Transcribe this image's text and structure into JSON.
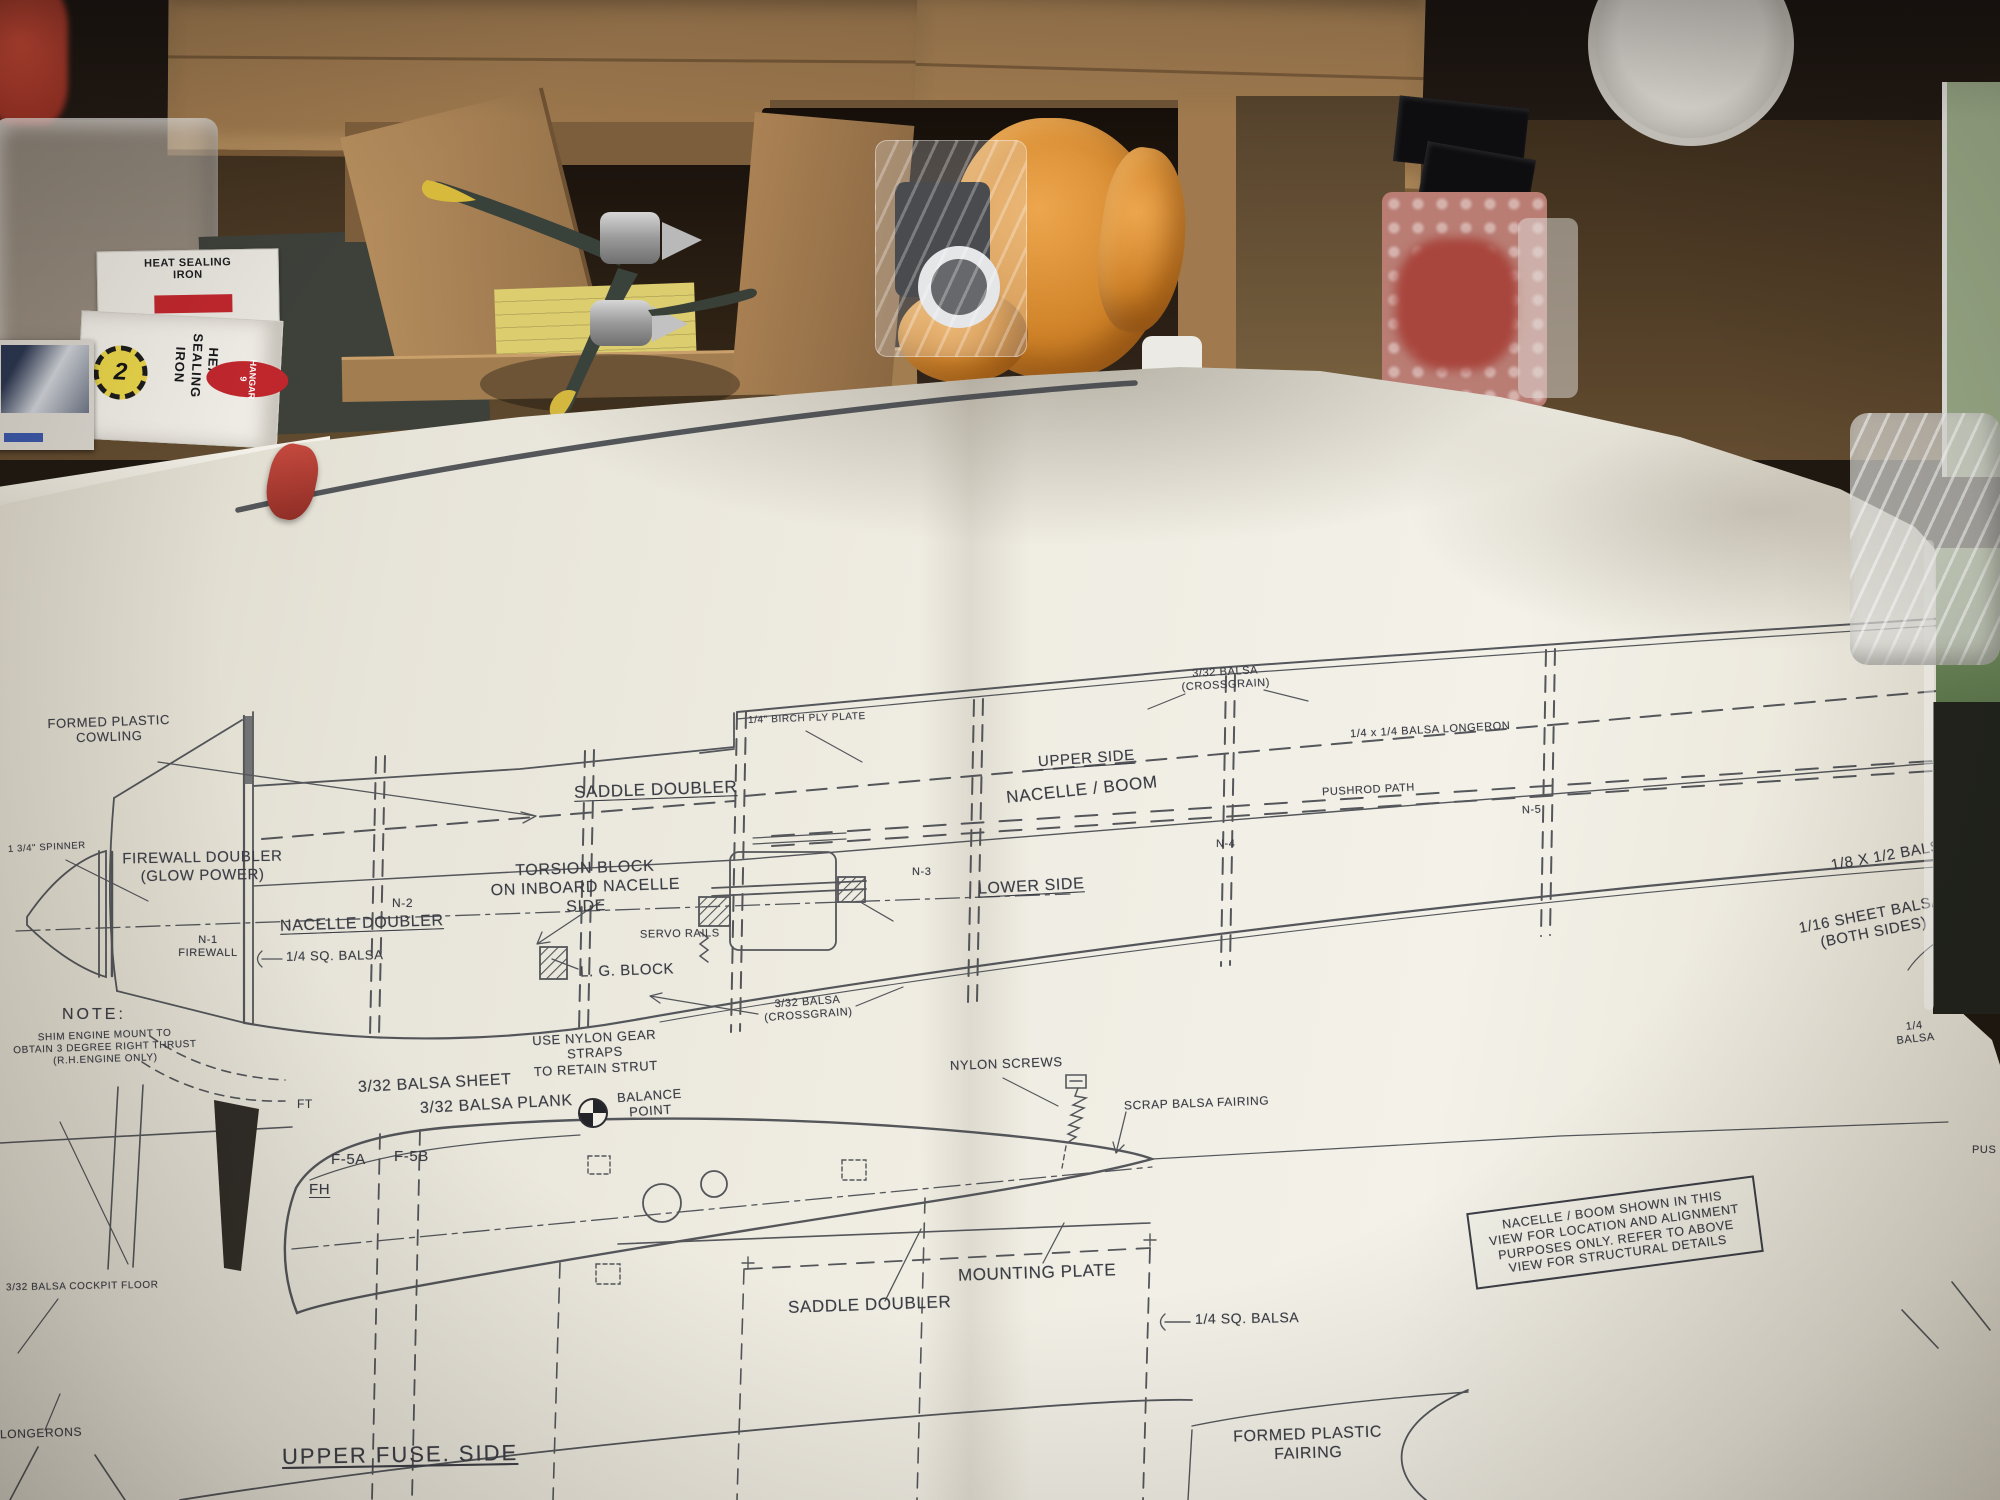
{
  "scene": {
    "description": "Model aircraft plan sheet unrolled across a workbench with kit boxes, propeller and tools"
  },
  "bench": {
    "heat_iron_box": {
      "top_label": "HEAT SEALING\nIRON",
      "brand": "HANGAR 9",
      "side_label": "HEAT\nSEALING\nIRON",
      "badge": "2"
    }
  },
  "plan": {
    "upper": {
      "formed_plastic_cowling": "FORMED PLASTIC\nCOWLING",
      "spinner": "1 3/4\" SPINNER",
      "firewall_doubler": "FIREWALL DOUBLER\n(GLOW POWER)",
      "n2": "N-2",
      "torsion_block": "TORSION BLOCK\nON INBOARD NACELLE\nSIDE",
      "nacelle_doubler": "NACELLE DOUBLER",
      "n1_firewall": "N-1\nFIREWALL",
      "quarter_sq_balsa": "1/4 SQ. BALSA",
      "note_title": "NOTE:",
      "note_body": "SHIM ENGINE MOUNT TO\nOBTAIN 3 DEGREE RIGHT THRUST\n(R.H.ENGINE ONLY)",
      "saddle_doubler": "SADDLE DOUBLER",
      "servo_rails": "SERVO RAILS",
      "lg_block": "L. G. BLOCK",
      "birch_ply_plate": "1/4\" BIRCH PLY PLATE",
      "crossgrain_top": "3/32 BALSA\n(CROSSGRAIN)",
      "upper_side": "UPPER SIDE",
      "nacelle_boom": "NACELLE / BOOM",
      "pushrod_path": "PUSHROD PATH",
      "balsa_longeron": "1/4 x 1/4 BALSA LONGERON",
      "n3": "N-3",
      "n4": "N-4",
      "n5": "N-5",
      "lower_side": "LOWER SIDE",
      "crossgrain_bottom": "3/32 BALSA\n(CROSSGRAIN)",
      "gear_straps": "USE NYLON GEAR STRAPS\nTO RETAIN STRUT",
      "balsa_18x12": "1/8 X 1/2 BALSA F",
      "sheet_balsa_116": "1/16 SHEET BALSA\n(BOTH SIDES)",
      "quarter_balsa": "1/4\nBALSA"
    },
    "lower": {
      "ft": "FT",
      "balsa_sheet_332": "3/32 BALSA SHEET",
      "balsa_plank_332": "3/32 BALSA PLANK",
      "balance_point": "BALANCE\nPOINT",
      "f5a": "F-5A",
      "f5b": "F-5B",
      "fh": "FH",
      "nylon_screws": "NYLON SCREWS",
      "scrap_balsa_fairing": "SCRAP BALSA FAIRING",
      "mounting_plate": "MOUNTING PLATE",
      "saddle_doubler": "SADDLE DOUBLER",
      "quarter_sq_balsa": "1/4 SQ. BALSA",
      "note_box": "NACELLE / BOOM SHOWN IN THIS\nVIEW FOR LOCATION AND ALIGNMENT\nPURPOSES ONLY. REFER TO ABOVE\nVIEW FOR STRUCTURAL DETAILS",
      "cockpit_floor": "3/32 BALSA COCKPIT FLOOR",
      "longerons": "LONGERONS",
      "upper_fuse_side": "UPPER FUSE. SIDE",
      "formed_plastic_fairing": "FORMED  PLASTIC\nFAIRING",
      "pushrod_partial": "PUS"
    },
    "colors": {
      "paper": "#e9e6db",
      "ink": "#3c3e46",
      "cardboard": "#a8825a",
      "towel_orange": "#d98a2e",
      "prop_tip_yellow": "#d7b93c",
      "brand_red": "#c0272d"
    }
  }
}
